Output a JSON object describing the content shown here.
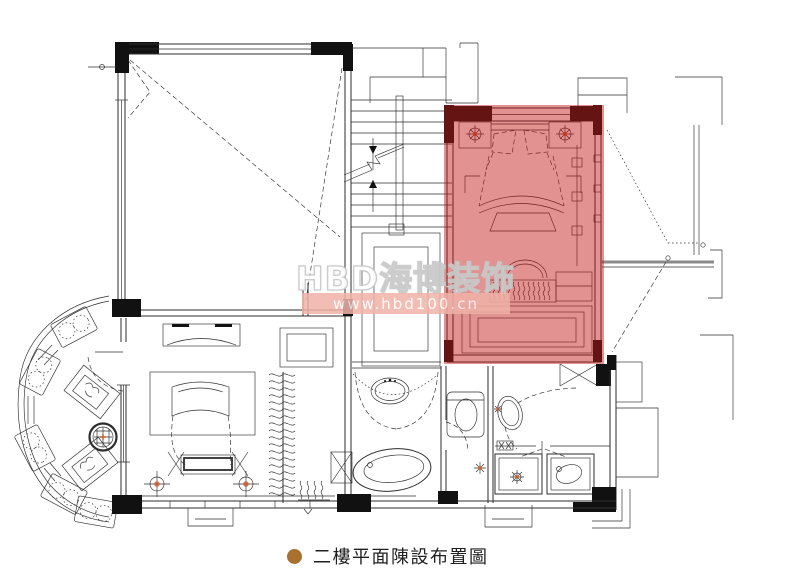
{
  "watermark": {
    "title": "HBD海博装饰",
    "url": "www.hbd100.cn"
  },
  "caption": {
    "text": "二樓平面陳設布置圖"
  },
  "colors": {
    "bg": "#ffffff",
    "line": "#2e2e2e",
    "wall": "#111111",
    "highlight": "#c11715",
    "band": "#f0b2a8",
    "watermark_text": "#ffffff",
    "watermark_outline": "#c9c9c9",
    "bullet": "#a9712f",
    "accent": "#c75b28",
    "caption_text": "#1f1f1f"
  }
}
